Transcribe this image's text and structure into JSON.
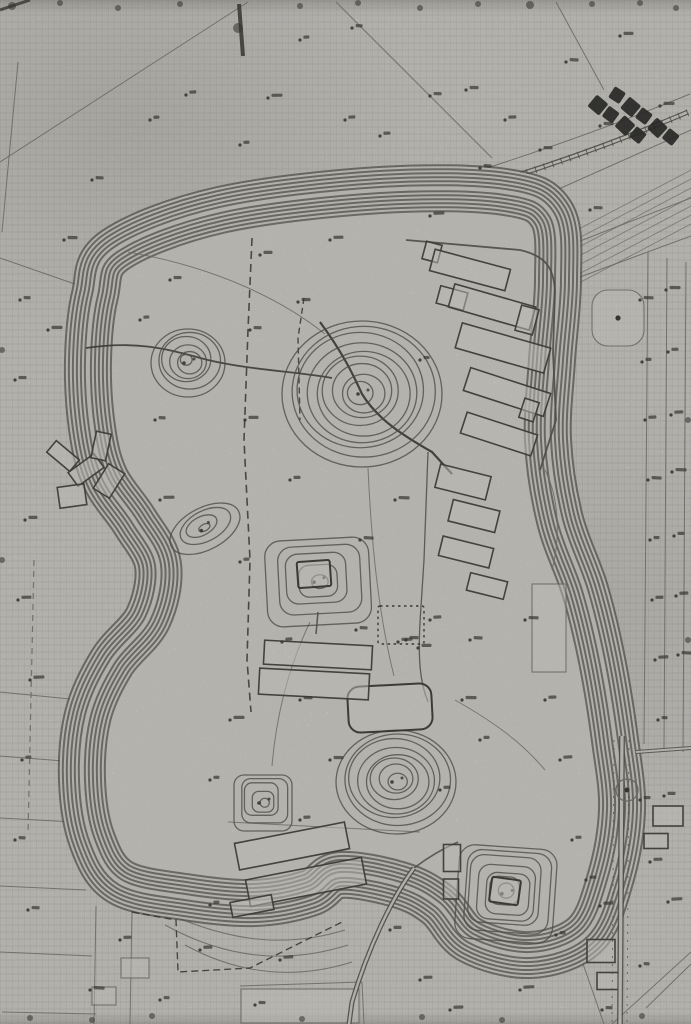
{
  "document": {
    "type": "scanned-topographic-site-survey-map",
    "description": "Black-and-white scanned contour map of a terraced plateau with burial mounds, buildings and field parcels",
    "background_color": "#d8d6d1",
    "ink_color": "#45423c",
    "bold_ink_color": "#22211e",
    "faint_ink_color": "#6d6a63",
    "stamp_ink_color": "#0d0d0c"
  },
  "stamp": {
    "name": "title-stamp-kanji-illegible",
    "rows": [
      5,
      4
    ],
    "rotation_deg": 38
  },
  "features": {
    "plateau": {
      "name": "central-plateau-contour-band",
      "contour_lines_across_band": 12
    },
    "mounds": [
      {
        "name": "round-mound-large-center",
        "cx": 362,
        "cy": 392,
        "rx": 80,
        "ry": 73,
        "rings": 9,
        "shape": "ellipse",
        "corner": 0,
        "rot": 0
      },
      {
        "name": "round-mound-small-west",
        "cx": 188,
        "cy": 361,
        "rx": 37,
        "ry": 34,
        "rings": 6,
        "shape": "ellipse",
        "corner": 0,
        "rot": 0
      },
      {
        "name": "oval-knoll-west",
        "cx": 204,
        "cy": 527,
        "rx": 38,
        "ry": 21,
        "rings": 4,
        "shape": "ellipse",
        "corner": 0,
        "rot": -28
      },
      {
        "name": "square-platform-mound-center",
        "cx": 318,
        "cy": 580,
        "rx": 52,
        "ry": 43,
        "rings": 5,
        "shape": "rect",
        "corner": 16,
        "rot": -3
      },
      {
        "name": "round-mound-south-center",
        "cx": 396,
        "cy": 780,
        "rx": 60,
        "ry": 52,
        "rings": 8,
        "shape": "ellipse",
        "corner": 0,
        "rot": 0
      },
      {
        "name": "small-square-mound-southwest",
        "cx": 263,
        "cy": 801,
        "rx": 29,
        "ry": 28,
        "rings": 5,
        "shape": "rect",
        "corner": 10,
        "rot": 0
      },
      {
        "name": "square-mound-southeast",
        "cx": 506,
        "cy": 892,
        "rx": 49,
        "ry": 47,
        "rings": 7,
        "shape": "rect",
        "corner": 16,
        "rot": 4
      }
    ],
    "buildings": [
      [
        432,
        252,
        16,
        18,
        15,
        "n",
        0
      ],
      [
        470,
        270,
        78,
        22,
        15,
        "n",
        0
      ],
      [
        452,
        298,
        28,
        18,
        15,
        "n",
        0
      ],
      [
        492,
        307,
        84,
        24,
        16,
        "n",
        0
      ],
      [
        503,
        348,
        92,
        26,
        16,
        "n",
        0
      ],
      [
        527,
        320,
        18,
        26,
        15,
        "n",
        0
      ],
      [
        507,
        392,
        84,
        24,
        18,
        "n",
        0
      ],
      [
        499,
        434,
        74,
        22,
        18,
        "n",
        0
      ],
      [
        529,
        410,
        15,
        20,
        18,
        "n",
        0
      ],
      [
        463,
        482,
        52,
        24,
        14,
        "n",
        0
      ],
      [
        474,
        516,
        48,
        22,
        14,
        "n",
        0
      ],
      [
        466,
        552,
        52,
        20,
        14,
        "n",
        0
      ],
      [
        487,
        586,
        38,
        18,
        14,
        "n",
        0
      ],
      [
        390,
        708,
        84,
        46,
        -3,
        "b",
        12
      ],
      [
        401,
        625,
        46,
        38,
        0,
        "d",
        2
      ],
      [
        318,
        655,
        108,
        24,
        3,
        "n",
        0
      ],
      [
        314,
        684,
        110,
        26,
        3,
        "n",
        0
      ],
      [
        314,
        574,
        33,
        26,
        -4,
        "b",
        2
      ],
      [
        505,
        891,
        29,
        25,
        8,
        "b",
        2
      ],
      [
        452,
        858,
        17,
        27,
        0,
        "n",
        0
      ],
      [
        451,
        889,
        15,
        20,
        0,
        "n",
        0
      ],
      [
        292,
        846,
        112,
        27,
        -11,
        "n",
        0
      ],
      [
        306,
        882,
        118,
        27,
        -11,
        "n",
        0
      ],
      [
        252,
        906,
        42,
        15,
        -11,
        "n",
        0
      ],
      [
        63,
        456,
        30,
        15,
        40,
        "n",
        0
      ],
      [
        86,
        470,
        32,
        17,
        -36,
        "n",
        0
      ],
      [
        101,
        446,
        15,
        27,
        12,
        "n",
        0
      ],
      [
        72,
        496,
        27,
        21,
        -8,
        "n",
        0
      ],
      [
        109,
        481,
        19,
        29,
        32,
        "n",
        0
      ],
      [
        618,
        318,
        52,
        56,
        0,
        "f",
        16
      ],
      [
        549,
        628,
        34,
        88,
        0,
        "f",
        0
      ],
      [
        668,
        816,
        30,
        20,
        0,
        "n",
        0
      ],
      [
        656,
        841,
        24,
        15,
        0,
        "n",
        0
      ],
      [
        601,
        951,
        28,
        23,
        0,
        "n",
        0
      ],
      [
        609,
        981,
        24,
        17,
        0,
        "n",
        0
      ],
      [
        300,
        1006,
        118,
        34,
        0,
        "f",
        0
      ],
      [
        135,
        968,
        28,
        20,
        0,
        "f",
        0
      ],
      [
        104,
        996,
        24,
        18,
        0,
        "f",
        0
      ]
    ],
    "spot_heights": [
      [
        300,
        40
      ],
      [
        352,
        28
      ],
      [
        430,
        96
      ],
      [
        466,
        90
      ],
      [
        620,
        36
      ],
      [
        268,
        98
      ],
      [
        150,
        120
      ],
      [
        186,
        95
      ],
      [
        92,
        180
      ],
      [
        540,
        150
      ],
      [
        600,
        126
      ],
      [
        660,
        106
      ],
      [
        240,
        145
      ],
      [
        380,
        136
      ],
      [
        505,
        120
      ],
      [
        566,
        62
      ],
      [
        640,
        300
      ],
      [
        666,
        290
      ],
      [
        642,
        362
      ],
      [
        668,
        352
      ],
      [
        645,
        420
      ],
      [
        671,
        415
      ],
      [
        648,
        480
      ],
      [
        672,
        472
      ],
      [
        650,
        540
      ],
      [
        674,
        536
      ],
      [
        652,
        600
      ],
      [
        676,
        596
      ],
      [
        655,
        660
      ],
      [
        678,
        655
      ],
      [
        658,
        720
      ],
      [
        640,
        800
      ],
      [
        664,
        796
      ],
      [
        650,
        862
      ],
      [
        600,
        906
      ],
      [
        668,
        902
      ],
      [
        640,
        966
      ],
      [
        602,
        1010
      ],
      [
        170,
        280
      ],
      [
        260,
        255
      ],
      [
        330,
        240
      ],
      [
        430,
        216
      ],
      [
        140,
        320
      ],
      [
        155,
        420
      ],
      [
        250,
        330
      ],
      [
        298,
        302
      ],
      [
        245,
        420
      ],
      [
        160,
        500
      ],
      [
        240,
        562
      ],
      [
        282,
        642
      ],
      [
        356,
        630
      ],
      [
        300,
        700
      ],
      [
        330,
        760
      ],
      [
        230,
        720
      ],
      [
        210,
        780
      ],
      [
        300,
        820
      ],
      [
        430,
        620
      ],
      [
        470,
        640
      ],
      [
        525,
        620
      ],
      [
        462,
        700
      ],
      [
        480,
        740
      ],
      [
        440,
        790
      ],
      [
        545,
        700
      ],
      [
        560,
        760
      ],
      [
        360,
        540
      ],
      [
        395,
        500
      ],
      [
        420,
        360
      ],
      [
        290,
        480
      ],
      [
        120,
        940
      ],
      [
        200,
        950
      ],
      [
        280,
        960
      ],
      [
        90,
        990
      ],
      [
        160,
        1000
      ],
      [
        255,
        1005
      ],
      [
        390,
        930
      ],
      [
        420,
        980
      ],
      [
        450,
        1010
      ],
      [
        520,
        990
      ],
      [
        556,
        935
      ],
      [
        20,
        300
      ],
      [
        15,
        380
      ],
      [
        25,
        520
      ],
      [
        18,
        600
      ],
      [
        30,
        680
      ],
      [
        22,
        760
      ],
      [
        15,
        840
      ],
      [
        28,
        910
      ],
      [
        406,
        640
      ],
      [
        418,
        648
      ],
      [
        398,
        642
      ],
      [
        210,
        905
      ],
      [
        345,
        120
      ],
      [
        480,
        168
      ],
      [
        590,
        210
      ],
      [
        64,
        240
      ],
      [
        48,
        330
      ],
      [
        572,
        840
      ],
      [
        586,
        880
      ]
    ],
    "edge_blobs": [
      [
        12,
        6,
        4
      ],
      [
        60,
        3,
        3
      ],
      [
        118,
        8,
        3
      ],
      [
        180,
        4,
        3
      ],
      [
        238,
        28,
        5
      ],
      [
        300,
        6,
        3
      ],
      [
        358,
        3,
        3
      ],
      [
        420,
        8,
        3
      ],
      [
        478,
        4,
        3
      ],
      [
        530,
        5,
        4
      ],
      [
        592,
        4,
        3
      ],
      [
        640,
        3,
        3
      ],
      [
        676,
        8,
        3
      ],
      [
        30,
        1018,
        3
      ],
      [
        92,
        1020,
        3
      ],
      [
        152,
        1016,
        3
      ],
      [
        302,
        1019,
        3
      ],
      [
        422,
        1017,
        3
      ],
      [
        502,
        1020,
        3
      ],
      [
        642,
        1016,
        3
      ],
      [
        2,
        350,
        3
      ],
      [
        2,
        560,
        3
      ],
      [
        688,
        420,
        3
      ],
      [
        688,
        640,
        3
      ]
    ]
  }
}
